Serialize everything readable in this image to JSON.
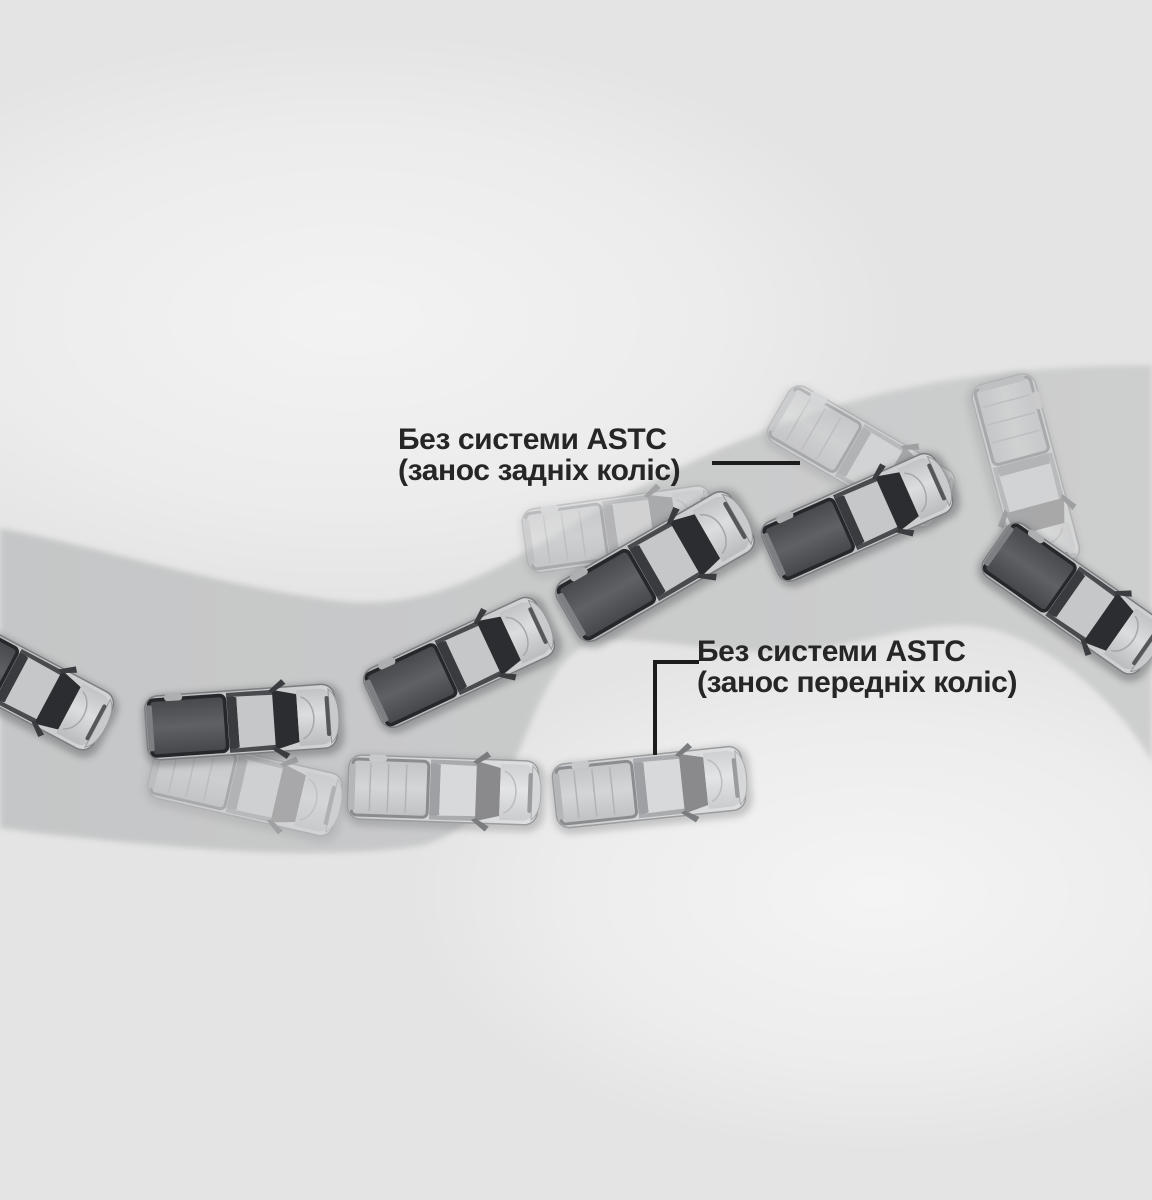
{
  "background": {
    "color": "#e4e4e4"
  },
  "diagram": {
    "road": {
      "color_start": "#c5c6c7",
      "color_end": "#cdcece"
    },
    "highlight_color": "#ffffff",
    "text_color": "#262626",
    "connector_color": "#1c1c1c",
    "labels": {
      "oversteer": {
        "line1": "Без системи ASTC",
        "line2": "(занос задніх коліс)",
        "x": 398,
        "y": 424,
        "connector": {
          "shape": "line",
          "x": 712,
          "y": 461,
          "h_length": 88,
          "thickness": 4
        }
      },
      "understeer": {
        "line1": "Без системи ASTC",
        "line2": "(занос передніх коліс)",
        "x": 697,
        "y": 636,
        "connector": {
          "shape": "elbow",
          "x": 653,
          "y": 660,
          "h_length": 46,
          "v_length": 95,
          "thickness": 4
        }
      }
    },
    "cars": [
      {
        "name": "ghost-car-oversteer-start",
        "variant": "pale",
        "x": 620,
        "y": 529,
        "rot": -8,
        "opacity": 0.5,
        "scale": 1
      },
      {
        "name": "ghost-car-rear-skid-1",
        "variant": "pale",
        "x": 862,
        "y": 457,
        "rot": 30,
        "opacity": 0.55,
        "scale": 1
      },
      {
        "name": "ghost-car-rear-skid-2",
        "variant": "pale",
        "x": 1026,
        "y": 474,
        "rot": 75,
        "opacity": 0.55,
        "scale": 1.02
      },
      {
        "name": "ghost-car-front-skid",
        "variant": "pale",
        "x": 246,
        "y": 786,
        "rot": 13,
        "opacity": 0.5,
        "scale": 1
      },
      {
        "name": "car-front-skid-2",
        "variant": "pale",
        "x": 444,
        "y": 790,
        "rot": 2,
        "opacity": 1,
        "scale": 1
      },
      {
        "name": "car-front-skid-1",
        "variant": "pale",
        "x": 650,
        "y": 787,
        "rot": -6,
        "opacity": 1,
        "scale": 1
      },
      {
        "name": "car-path-1",
        "variant": "dark",
        "x": 20,
        "y": 682,
        "rot": 28,
        "opacity": 1,
        "scale": 1
      },
      {
        "name": "car-path-2",
        "variant": "dark",
        "x": 242,
        "y": 722,
        "rot": -4,
        "opacity": 1,
        "scale": 1
      },
      {
        "name": "car-path-3",
        "variant": "dark",
        "x": 460,
        "y": 662,
        "rot": -25,
        "opacity": 1,
        "scale": 1
      },
      {
        "name": "car-path-4",
        "variant": "dark",
        "x": 656,
        "y": 566,
        "rot": -30,
        "opacity": 1,
        "scale": 1.06
      },
      {
        "name": "car-path-5",
        "variant": "dark",
        "x": 858,
        "y": 517,
        "rot": -24,
        "opacity": 1,
        "scale": 1
      },
      {
        "name": "car-path-6",
        "variant": "dark",
        "x": 1074,
        "y": 599,
        "rot": 35,
        "opacity": 1,
        "scale": 1
      }
    ]
  }
}
